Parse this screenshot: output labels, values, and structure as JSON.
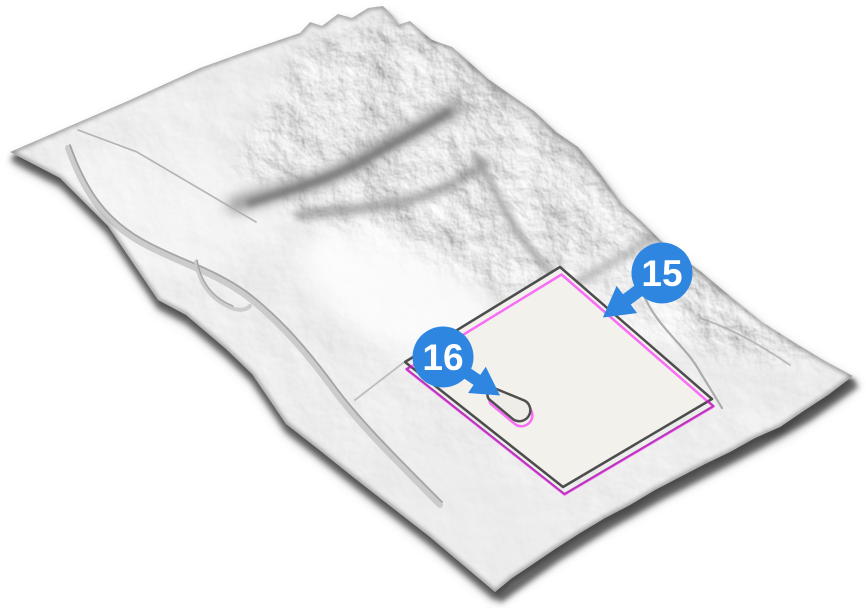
{
  "scene": {
    "badges": [
      {
        "label": "15"
      },
      {
        "label": "16"
      }
    ],
    "colors": {
      "badge_blue": "#2f86e0",
      "badge_text": "#ffffff",
      "overlay_magenta": "#ff00ff",
      "site_fill": "#f2f1ec",
      "site_border": "#4d4d4d",
      "footprint_gray": "#606060",
      "pond_fill": "#eeede8",
      "pond_border": "#4f4f4f"
    }
  }
}
